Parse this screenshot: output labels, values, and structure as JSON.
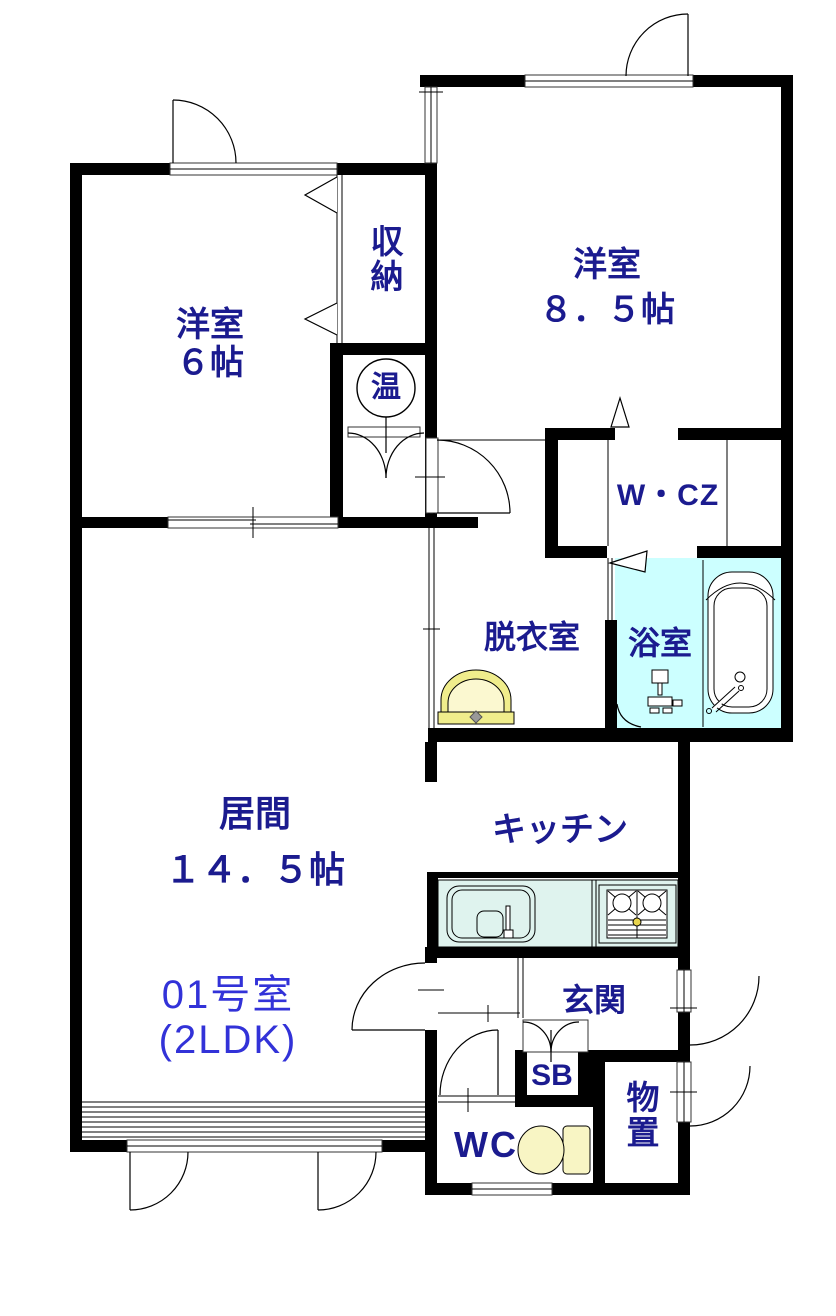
{
  "unit": {
    "number": "01号室",
    "layout": "(2LDK)"
  },
  "rooms": {
    "western6": {
      "name": "洋室",
      "size": "６帖"
    },
    "western85": {
      "name": "洋室",
      "size": "８．５帖"
    },
    "closet": {
      "name": "収納"
    },
    "water_heater": {
      "name": "温"
    },
    "wcz": {
      "name": "W・CZ"
    },
    "dressing": {
      "name": "脱衣室"
    },
    "bathroom": {
      "name": "浴室"
    },
    "living": {
      "name": "居間",
      "size": "１４．５帖"
    },
    "kitchen": {
      "name": "キッチン"
    },
    "entrance": {
      "name": "玄関"
    },
    "shoe_box": {
      "name": "SB"
    },
    "storeroom": {
      "name": "物置"
    },
    "toilet": {
      "name": "WC"
    }
  },
  "colors": {
    "label_navy": "#1b1b8f",
    "unit_blue": "#3232d8",
    "bathroom_floor": "#ccffff",
    "kitchen_counter": "#dff3ee",
    "basin_yellow": "#f0ed8c",
    "toilet_yellow": "#f8f5c4"
  }
}
